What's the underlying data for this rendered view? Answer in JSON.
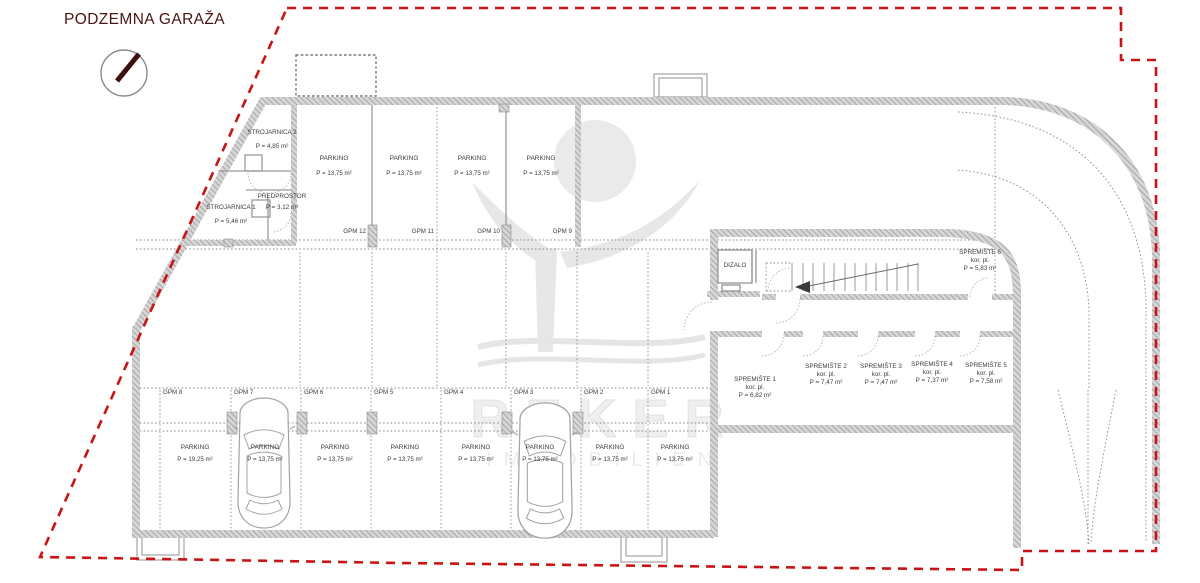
{
  "title": "PODZEMNA GARAŽA",
  "watermark": {
    "line1": "REKER",
    "line2": "IMMOBILIEN"
  },
  "parking_top": [
    {
      "gpm": "GPM 12",
      "name": "PARKING",
      "area": "P = 13,75 m²"
    },
    {
      "gpm": "GPM 11",
      "name": "PARKING",
      "area": "P = 13,75 m²"
    },
    {
      "gpm": "GPM 10",
      "name": "PARKING",
      "area": "P = 13,75 m²"
    },
    {
      "gpm": "GPM 9",
      "name": "PARKING",
      "area": "P = 13,75 m²"
    }
  ],
  "parking_bottom": [
    {
      "gpm": "GPM 8",
      "name": "PARKING",
      "area": "P = 19,25 m²"
    },
    {
      "gpm": "GPM 7",
      "name": "PARKING",
      "area": "P = 13,75 m²"
    },
    {
      "gpm": "GPM 6",
      "name": "PARKING",
      "area": "P = 13,75 m²"
    },
    {
      "gpm": "GPM 5",
      "name": "PARKING",
      "area": "P = 13,75 m²"
    },
    {
      "gpm": "GPM 4",
      "name": "PARKING",
      "area": "P = 13,75 m²"
    },
    {
      "gpm": "GPM 3",
      "name": "PARKING",
      "area": "P = 13,75 m²"
    },
    {
      "gpm": "GPM 2",
      "name": "PARKING",
      "area": "P = 13,75 m²"
    },
    {
      "gpm": "GPM 1",
      "name": "PARKING",
      "area": "P = 13,75 m²"
    }
  ],
  "rooms": {
    "strojarnica2": {
      "name": "STROJARNICA 2",
      "area": "P = 4,85 m²"
    },
    "predprostor": {
      "name": "PREDPROSTOR",
      "area": "P = 3,12 m²"
    },
    "strojarnica1": {
      "name": "STROJARNICA 1",
      "area": "P = 5,46 m²"
    },
    "dizalo": {
      "name": "DIZALO"
    }
  },
  "storage": [
    {
      "name": "SPREMIŠTE 1",
      "sub": "kor. pl.",
      "area": "P = 6,82 m²"
    },
    {
      "name": "SPREMIŠTE 2",
      "sub": "kor. pl.",
      "area": "P = 7,47 m²"
    },
    {
      "name": "SPREMIŠTE 3",
      "sub": "kor. pl.",
      "area": "P = 7,47 m²"
    },
    {
      "name": "SPREMIŠTE 4",
      "sub": "kor. pl.",
      "area": "P = 7,37 m²"
    },
    {
      "name": "SPREMIŠTE 5",
      "sub": "kor. pl.",
      "area": "P = 7,58 m²"
    },
    {
      "name": "SPREMIŠTE 6",
      "sub": "kor. pl.",
      "area": "P = 5,83 m²"
    }
  ],
  "colors": {
    "boundary": "#c81414",
    "title": "#4a1414",
    "walls": "#bdbdbd",
    "text": "#3b3b3b"
  }
}
